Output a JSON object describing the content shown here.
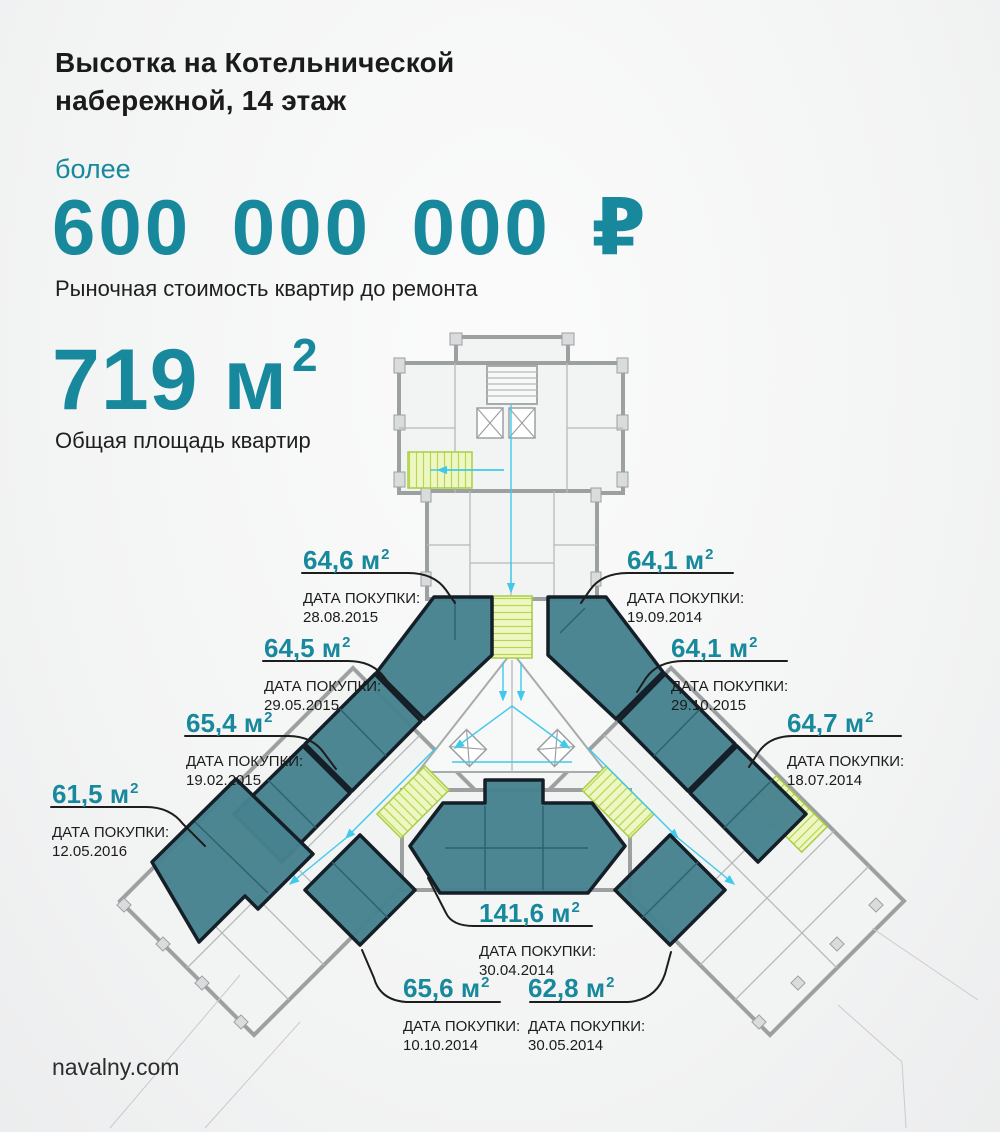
{
  "colors": {
    "accent": "#18899d",
    "apartment_fill": "#47828f",
    "plan_line": "#9da0a1",
    "stairs_green": "#a9cd45",
    "duct_cyan": "#41c9ec"
  },
  "header": {
    "title_line1": "Высотка на Котельнической",
    "title_line2": "набережной, 14 этаж",
    "price_prefix": "более",
    "price_value": "600 000 000 ₽",
    "price_caption": "Рыночная стоимость квартир до ремонта",
    "area_value": "719 м",
    "area_sup": "2",
    "area_caption": "Общая площадь квартир"
  },
  "purchase_caption": "ДАТА ПОКУПКИ:",
  "apartments": [
    {
      "area": "64,6 м",
      "sup": "2",
      "date": "28.08.2015"
    },
    {
      "area": "64,1 м",
      "sup": "2",
      "date": "19.09.2014"
    },
    {
      "area": "64,5 м",
      "sup": "2",
      "date": "29.05.2015"
    },
    {
      "area": "64,1 м",
      "sup": "2",
      "date": "29.10.2015"
    },
    {
      "area": "65,4 м",
      "sup": "2",
      "date": "19.02.2015"
    },
    {
      "area": "64,7 м",
      "sup": "2",
      "date": "18.07.2014"
    },
    {
      "area": "61,5 м",
      "sup": "2",
      "date": "12.05.2016"
    },
    {
      "area": "141,6 м",
      "sup": "2",
      "date": "30.04.2014"
    },
    {
      "area": "65,6 м",
      "sup": "2",
      "date": "10.10.2014"
    },
    {
      "area": "62,8 м",
      "sup": "2",
      "date": "30.05.2014"
    }
  ],
  "footer": {
    "site": "navalny.com"
  }
}
